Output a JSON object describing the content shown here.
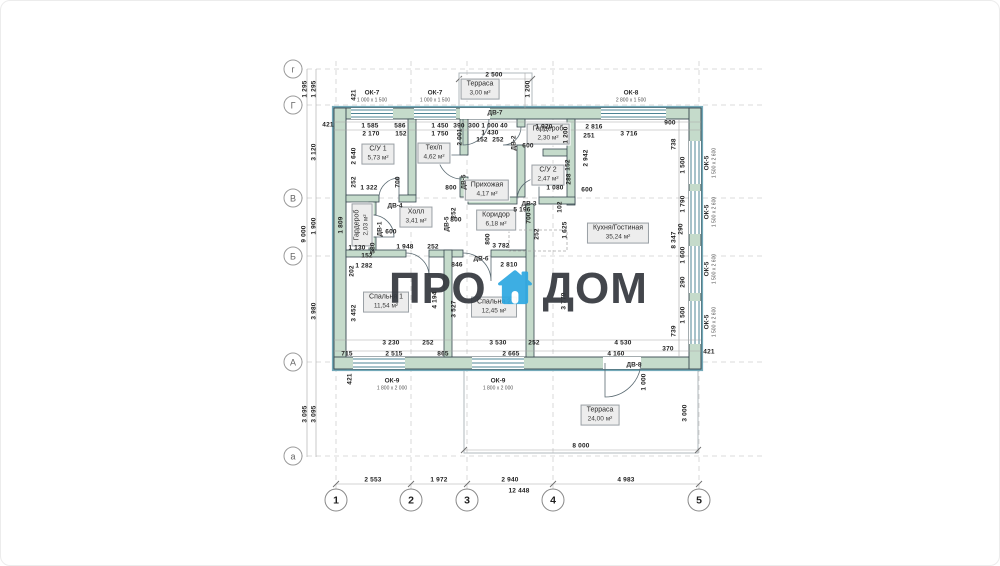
{
  "watermark": {
    "left": "ПРО",
    "right": "ДОМ",
    "icon": "house-icon",
    "text_color": "#35393f",
    "icon_color": "#2fa8e1"
  },
  "palette": {
    "wall_fill": "#c5dbcb",
    "wall_edge": "#37474f",
    "exterior_face": "#73a9b8",
    "glazing": "#4d8496",
    "dim_text": "#1d1d1d"
  },
  "grid": {
    "rows": [
      "г",
      "Г",
      "В",
      "Б",
      "А",
      "а"
    ],
    "cols": [
      "1",
      "2",
      "3",
      "4",
      "5"
    ]
  },
  "rooms": [
    {
      "name": "Терраса",
      "area": "3,00 м²"
    },
    {
      "name": "С/У 1",
      "area": "5,73 м²"
    },
    {
      "name": "Тех/п",
      "area": "4,62 м²"
    },
    {
      "name": "Гардероб",
      "area": "2,30 м²"
    },
    {
      "name": "С/У 2",
      "area": "2,47 м²"
    },
    {
      "name": "Прихожая",
      "area": "4,17 м²"
    },
    {
      "name": "Холл",
      "area": "3,41 м²"
    },
    {
      "name": "Коридор",
      "area": "6,18 м²"
    },
    {
      "name": "Гардероб",
      "area": "2,03 м²"
    },
    {
      "name": "Кухня/Гостиная",
      "area": "35,24 м²"
    },
    {
      "name": "Спальня 1",
      "area": "11,54 м²"
    },
    {
      "name": "Спальня 2",
      "area": "12,45 м²"
    },
    {
      "name": "Терраса",
      "area": "24,00 м²"
    }
  ],
  "windows": [
    {
      "code": "ОК-7",
      "size": "1 000 х 1 500"
    },
    {
      "code": "ОК-7",
      "size": "1 000 х 1 500"
    },
    {
      "code": "ОК-8",
      "size": "2 800 х 1 500"
    },
    {
      "code": "ОК-5",
      "size": "1 500 х 2 600"
    },
    {
      "code": "ОК-5",
      "size": "1 500 х 2 600"
    },
    {
      "code": "ОК-5",
      "size": "1 500 х 2 600"
    },
    {
      "code": "ОК-5",
      "size": "1 500 х 2 600"
    },
    {
      "code": "ОК-9",
      "size": "1 800 х 2 000"
    },
    {
      "code": "ОК-9",
      "size": "1 800 х 2 000"
    }
  ],
  "doors": [
    "ДВ-7",
    "ДВ-2",
    "ДВ-3",
    "ДВ-4",
    "ДВ-5",
    "ДВ-5",
    "ДВ-6",
    "ДВ-1",
    "ДВ-8"
  ],
  "dims": [
    "2 500",
    "1 200",
    "421",
    "421",
    "1 585",
    "586",
    "2 170",
    "152",
    "1 450",
    "1 750",
    "390",
    "300",
    "1 000",
    "40",
    "1 430",
    "152",
    "252",
    "2 001",
    "1 920",
    "1 200",
    "251",
    "2 816",
    "3 716",
    "900",
    "738",
    "2 640",
    "252",
    "1 322",
    "700",
    "800",
    "600",
    "152",
    "288",
    "1 080",
    "600",
    "2 942",
    "102",
    "5 196",
    "700",
    "1 625",
    "1 809",
    "600",
    "1 130",
    "580",
    "152",
    "1 948",
    "252",
    "800",
    "1 282",
    "202",
    "846",
    "2 810",
    "252",
    "252",
    "800",
    "3 782",
    "4 194",
    "3 527",
    "3 779",
    "3 452",
    "3 230",
    "252",
    "3 530",
    "252",
    "4 530",
    "715",
    "2 515",
    "865",
    "2 665",
    "4 160",
    "370",
    "421",
    "421",
    "1 000",
    "3 000",
    "8 000",
    "1 500",
    "1 790",
    "290",
    "8 347",
    "1 600",
    "290",
    "1 500",
    "739",
    "1 295",
    "1 295",
    "3 120",
    "9 000",
    "1 900",
    "3 980",
    "3 095",
    "3 095",
    "2 553",
    "1 972",
    "2 940",
    "12 448",
    "4 983"
  ]
}
